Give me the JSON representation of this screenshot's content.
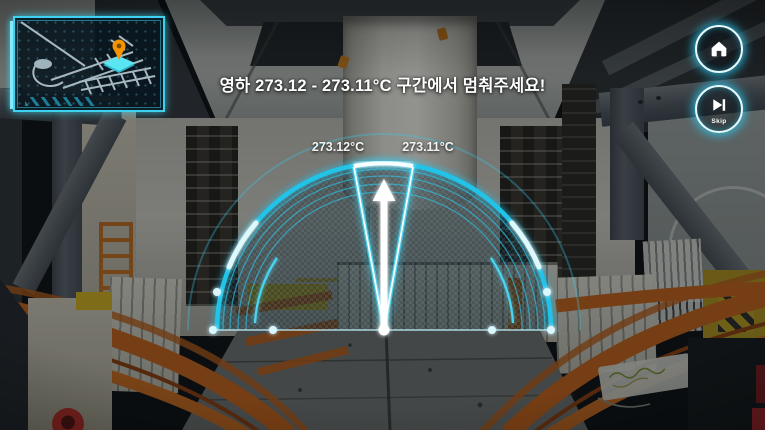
{
  "prompt": {
    "text": "영하 273.12 - 273.11°C 구간에서 멈춰주세요!"
  },
  "gauge": {
    "left_label": "273.12°C",
    "right_label": "273.11°C",
    "accent_color": "#2fd0f2",
    "needle_color": "#ffffff",
    "needle_direction": "up"
  },
  "hud": {
    "buttons": [
      {
        "name": "home",
        "icon": "home-icon",
        "label": ""
      },
      {
        "name": "skip",
        "icon": "skip-forward-icon",
        "label": "Skip"
      }
    ]
  },
  "minimap": {
    "pin_icon": "location-pin-icon",
    "pin_color": "#f59300",
    "frame_color": "#3ed2ef"
  },
  "colors": {
    "accent": "#2fd0f2",
    "rail_orange": "#c2611a"
  }
}
